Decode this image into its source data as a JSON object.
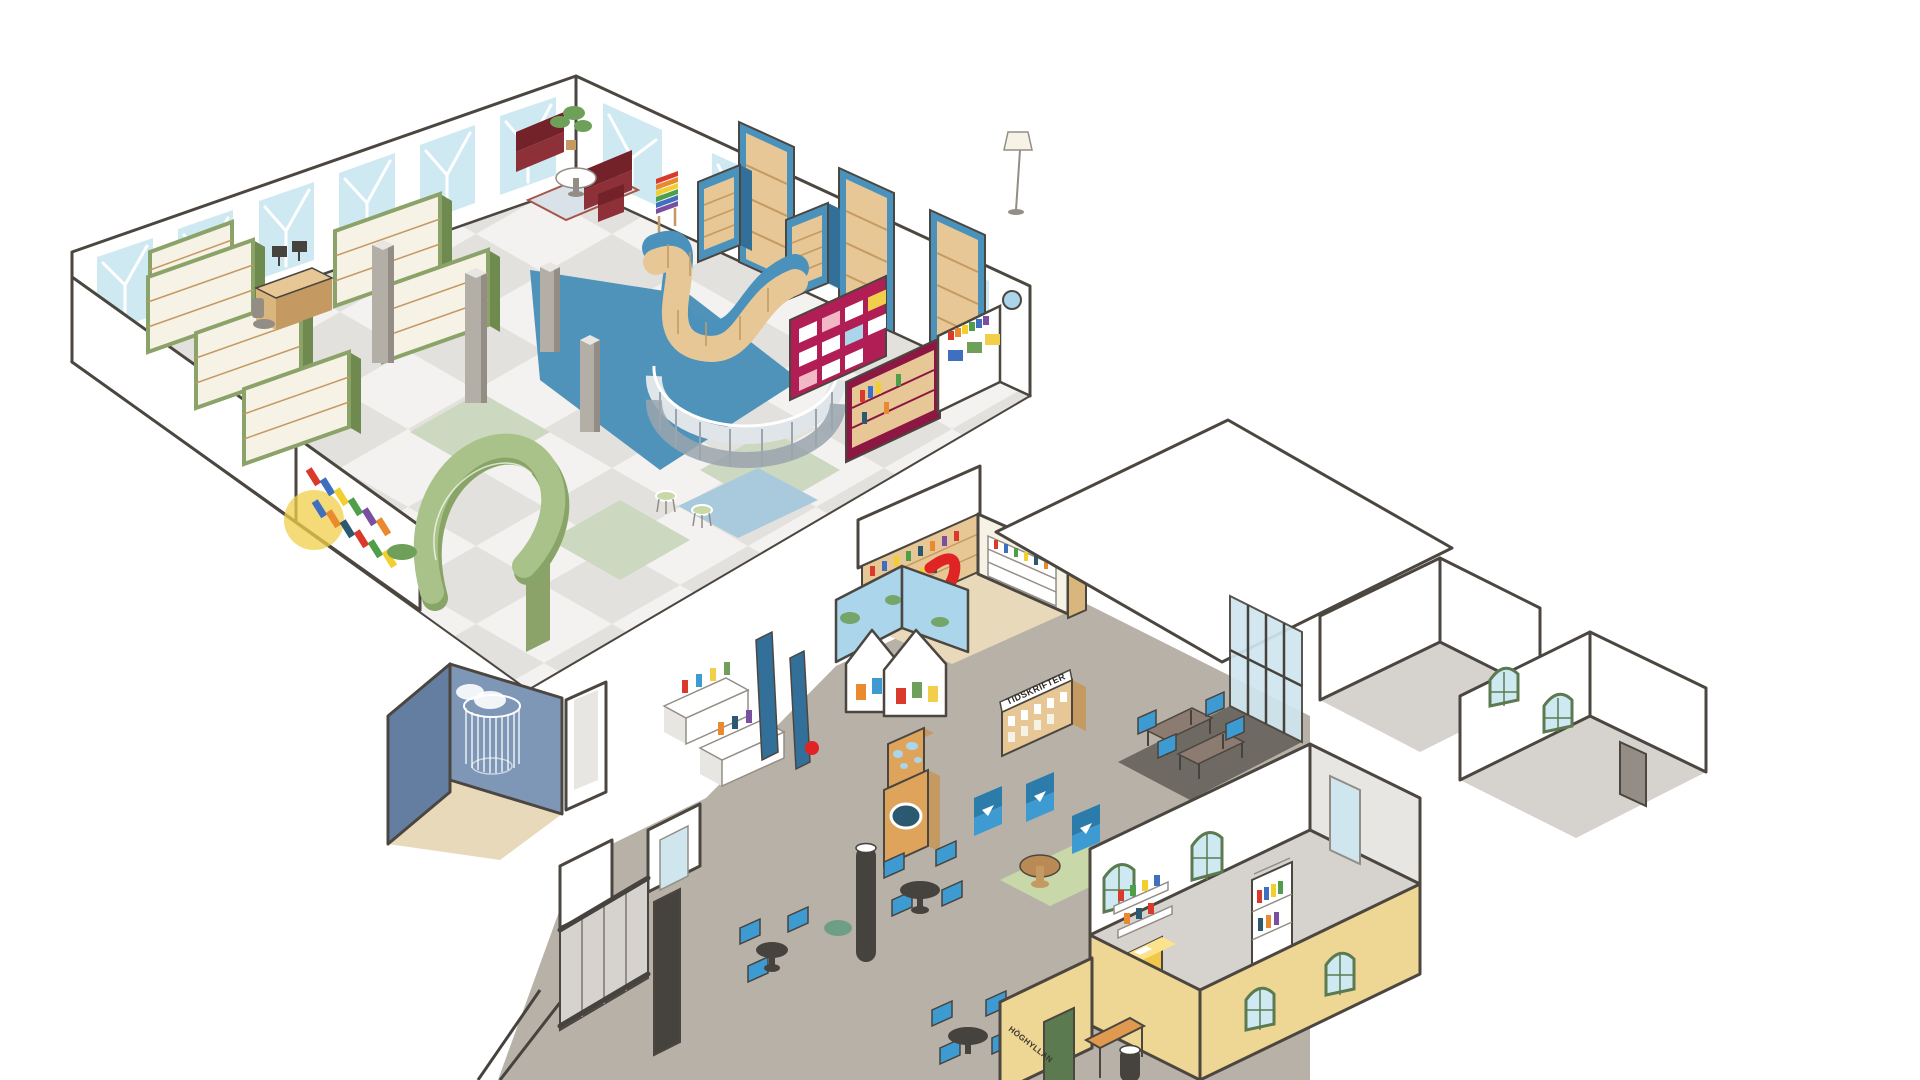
{
  "illustration": {
    "kind": "isometric cutaway floor plan of a public library",
    "background": "#ffffff"
  },
  "labels": {
    "magazine_shelf": "TIDSKRIFTER",
    "entrance_wall": "HÖGHYLLAN"
  },
  "areas": [
    {
      "id": "main-hall",
      "name": "Main library hall with checkered floor"
    },
    {
      "id": "green-shelf-stacks",
      "name": "Green bookshelf stacks with info desk"
    },
    {
      "id": "sofa-lounge",
      "name": "Chesterfield sofa lounge"
    },
    {
      "id": "wavy-shelf",
      "name": "Serpentine wooden shelf with blue top"
    },
    {
      "id": "green-arch-shelf",
      "name": "Green arch display shelf"
    },
    {
      "id": "glass-rotunda",
      "name": "Curved glass wall with wire chairs"
    },
    {
      "id": "magenta-display",
      "name": "Magenta display shelves"
    },
    {
      "id": "story-room",
      "name": "Blue story room with string canopy"
    },
    {
      "id": "slide-room",
      "name": "Children's room with red slide"
    },
    {
      "id": "picture-book-mountains",
      "name": "Mountain-shaped picture book shelves"
    },
    {
      "id": "magazine-corner",
      "name": "Magazine shelf area (Tidskrifter)"
    },
    {
      "id": "cafe-seating",
      "name": "Café seating with blue chairs"
    },
    {
      "id": "study-room",
      "name": "Glazed group study room"
    },
    {
      "id": "right-wing",
      "name": "White-walled office wing"
    },
    {
      "id": "yellow-building",
      "name": "Yellow entrance building with green door"
    },
    {
      "id": "entrance-hall",
      "name": "Entrance hall with escalator and pillars"
    }
  ],
  "palette": {
    "out": "#4b463f",
    "wht": "#ffffff",
    "crm": "#f7f2e6",
    "shdw": "#e8e6e2",
    "fl2": "#e3e1dd",
    "flg": "#ccd8c0",
    "flb": "#4f93bb",
    "rb": "#a9c9dd",
    "winp": "#cfe9f3",
    "grn": "#8ba368",
    "grnD": "#6f8a4e",
    "blu": "#4a92bc",
    "bluD": "#32709a",
    "wd": "#e7c795",
    "wdD": "#c49a62",
    "wdM": "#d9b67e",
    "mag": "#b01e55",
    "magD": "#8c1743",
    "sofa": "#8e3038",
    "sofaD": "#722228",
    "gls": "#dfe5e8",
    "glsF": "#9aa5ad",
    "glsP": "#cfe6ee",
    "agr": "#a9c289",
    "agrD": "#88a466",
    "sb": "#647ea1",
    "sbL": "#7e97b6",
    "sfl": "#e9d9bb",
    "cfl": "#b7b1a8",
    "fl2g": "#d6d3ce",
    "dkfl": "#6e6962",
    "yel": "#eed694",
    "dgr": "#5c7a50",
    "cb": "#3d9bd1",
    "cbD": "#2b7bab",
    "tbr": "#8b7b70",
    "tbl": "#b98a54",
    "dk": "#46423d",
    "red": "#e02424",
    "sky": "#aad5ea",
    "pouf": "#f2c84b",
    "rgr": "#c8d8a8",
    "pil": "#b3aea6",
    "gm": "#938d85",
    "leaf": "#6fa05a",
    "or": "#df9a50",
    "or2": "#dfa45c",
    "teal": "#2b5a70",
    "pnk": "#f2b8c6",
    "ylwC": "#f2cf4a",
    "rugc": "#d9e2e8",
    "rugb": "#a65548",
    "purp": "#7a4fa0",
    "orn": "#ea8a2e",
    "grnB": "#4f9e4a",
    "blub": "#3f6fbf",
    "redb": "#d93a2b",
    "ylwb": "#f2cf2e"
  }
}
